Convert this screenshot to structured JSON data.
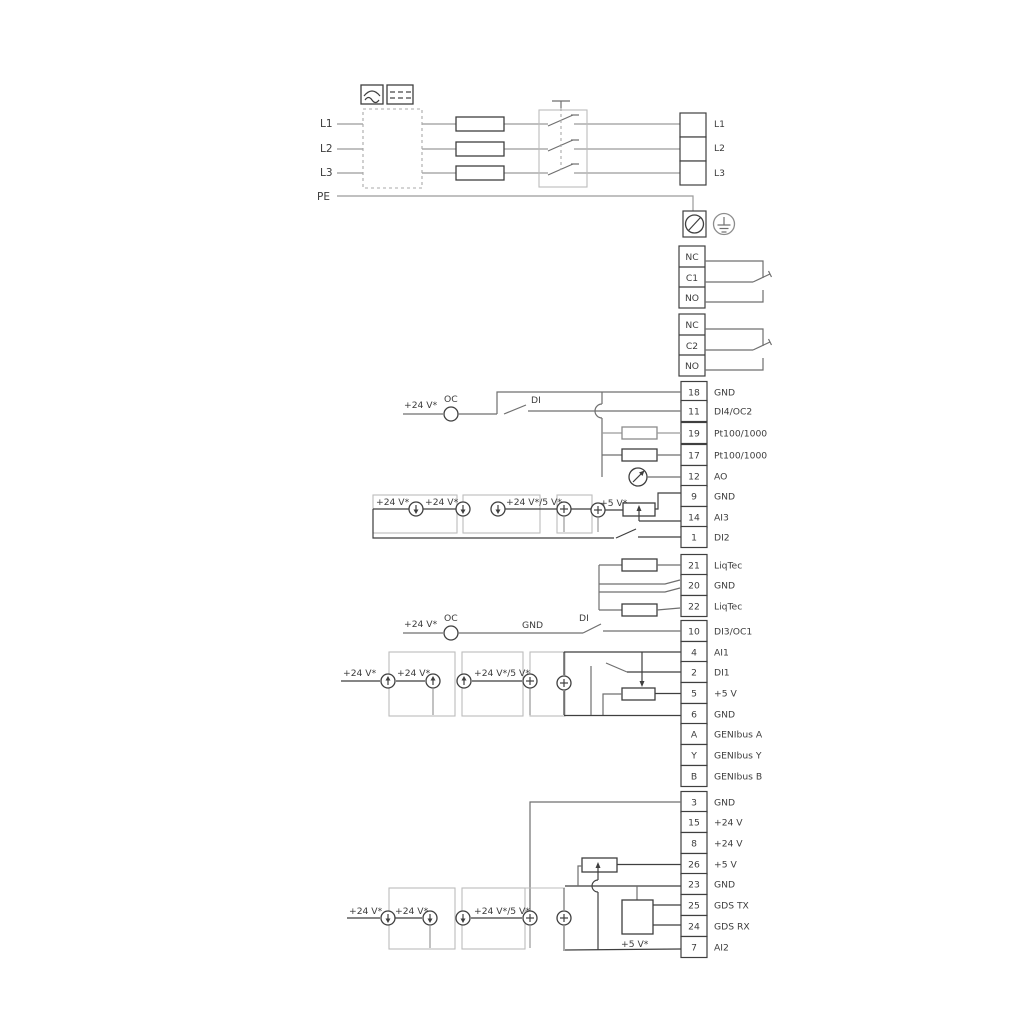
{
  "mains": {
    "in": [
      "L1",
      "L2",
      "L3",
      "PE"
    ],
    "out": [
      "L1",
      "L2",
      "L3"
    ]
  },
  "relays": [
    {
      "t": "NC",
      "m": "C1",
      "b": "NO"
    },
    {
      "t": "NC",
      "m": "C2",
      "b": "NO"
    }
  ],
  "terminals": [
    {
      "num": "18",
      "label": "GND"
    },
    {
      "num": "11",
      "label": "DI4/OC2"
    },
    {
      "num": "19",
      "label": "Pt100/1000"
    },
    {
      "num": "17",
      "label": "Pt100/1000"
    },
    {
      "num": "12",
      "label": "AO"
    },
    {
      "num": "9",
      "label": "GND"
    },
    {
      "num": "14",
      "label": "AI3"
    },
    {
      "num": "1",
      "label": "DI2"
    },
    {
      "num": "21",
      "label": "LiqTec"
    },
    {
      "num": "20",
      "label": "GND"
    },
    {
      "num": "22",
      "label": "LiqTec"
    },
    {
      "num": "10",
      "label": "DI3/OC1"
    },
    {
      "num": "4",
      "label": "AI1"
    },
    {
      "num": "2",
      "label": "DI1"
    },
    {
      "num": "5",
      "label": "+5 V"
    },
    {
      "num": "6",
      "label": "GND"
    },
    {
      "num": "A",
      "label": "GENIbus A"
    },
    {
      "num": "Y",
      "label": "GENIbus Y"
    },
    {
      "num": "B",
      "label": "GENIbus B"
    },
    {
      "num": "3",
      "label": "GND"
    },
    {
      "num": "15",
      "label": "+24 V"
    },
    {
      "num": "8",
      "label": "+24 V"
    },
    {
      "num": "26",
      "label": "+5 V"
    },
    {
      "num": "23",
      "label": "GND"
    },
    {
      "num": "25",
      "label": "GDS TX"
    },
    {
      "num": "24",
      "label": "GDS RX"
    },
    {
      "num": "7",
      "label": "AI2"
    }
  ],
  "labels": {
    "v24": "+24 V*",
    "v24_5": "+24 V*/5 V*",
    "v5": "+5 V*",
    "oc": "OC",
    "di": "DI",
    "gnd": "GND"
  },
  "colors": {
    "wire_light": "#9a9a9a",
    "wire_mid": "#6f6f6f",
    "wire_dark": "#3f3f3f",
    "group_box": "#bcbcbc",
    "text": "#3c3c3c",
    "background": "#ffffff"
  }
}
